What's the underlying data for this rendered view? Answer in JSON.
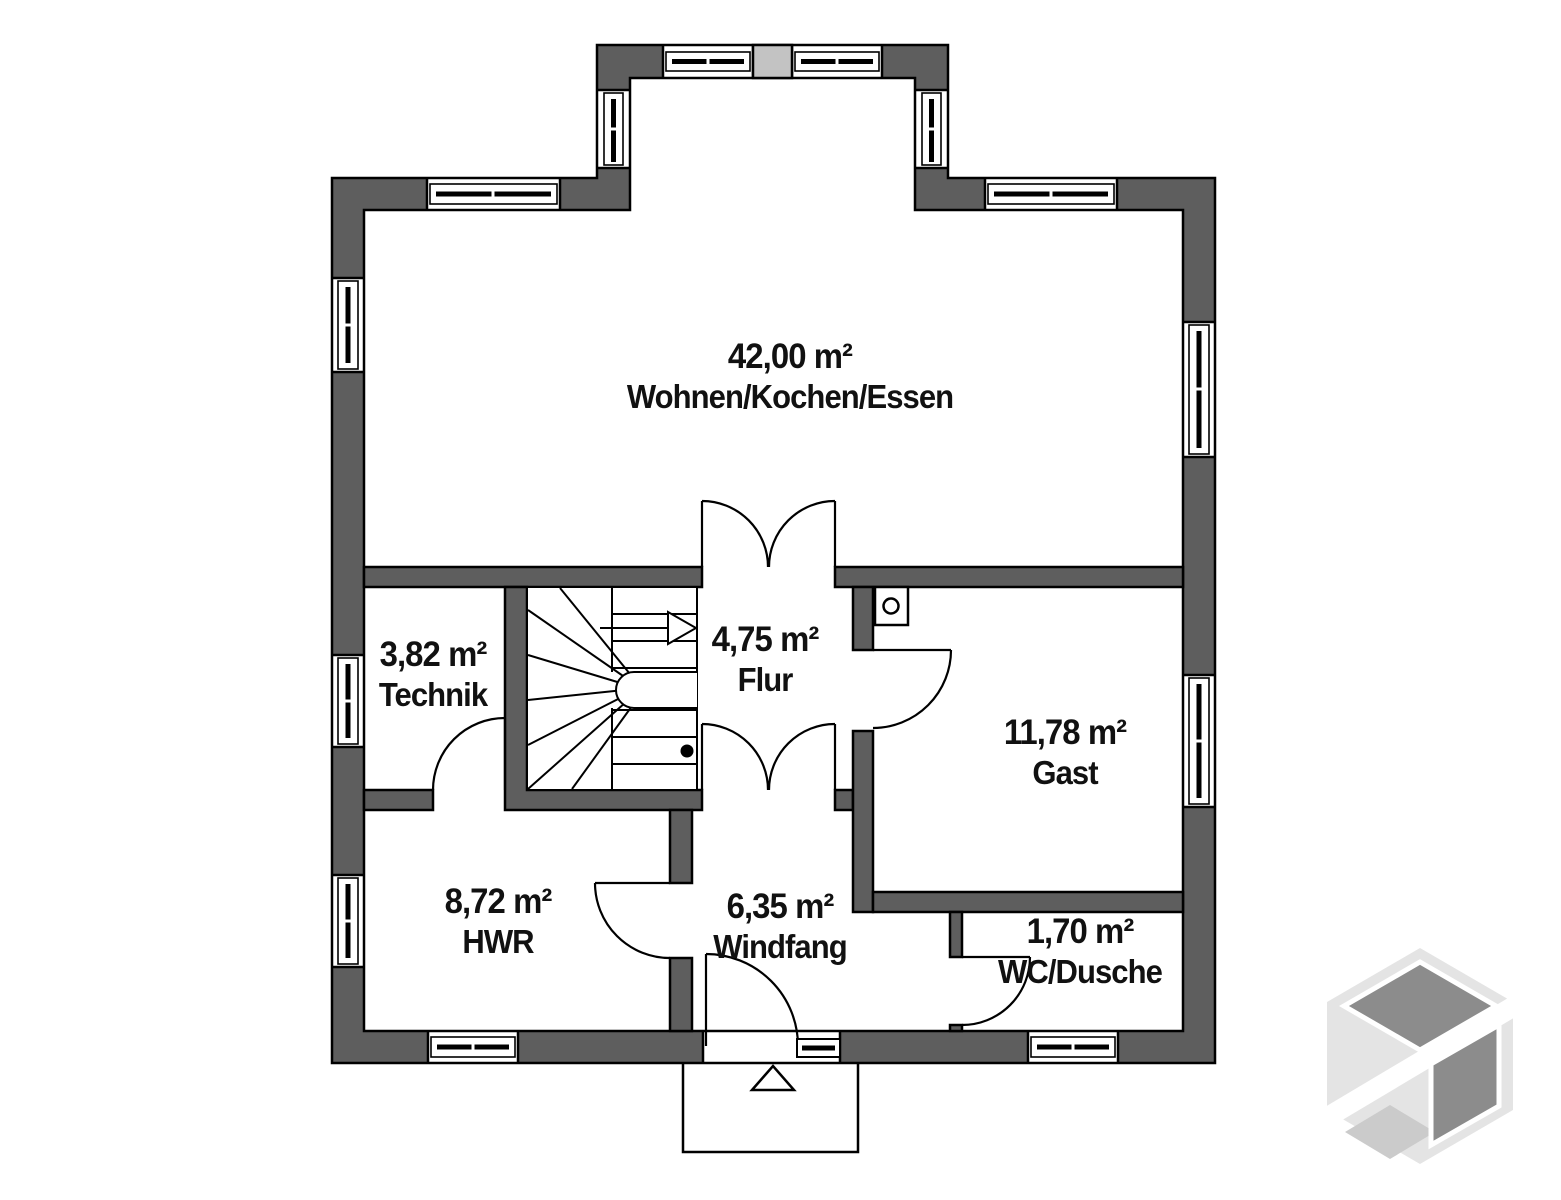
{
  "plan": {
    "rooms": [
      {
        "area": "42,00 m²",
        "name": "Wohnen/Kochen/Essen"
      },
      {
        "area": "3,82 m²",
        "name": "Technik"
      },
      {
        "area": "4,75 m²",
        "name": "Flur"
      },
      {
        "area": "11,78 m²",
        "name": "Gast"
      },
      {
        "area": "8,72 m²",
        "name": "HWR"
      },
      {
        "area": "6,35 m²",
        "name": "Windfang"
      },
      {
        "area": "1,70 m²",
        "name": "WC/Dusche"
      }
    ],
    "colors": {
      "wall": "#5e5e5e",
      "line": "#000000",
      "chimney_block": "#c3c3c3",
      "logo_light": "#e4e4e4",
      "logo_mid": "#cbcbcb",
      "logo_dark": "#8c8c8c"
    }
  }
}
